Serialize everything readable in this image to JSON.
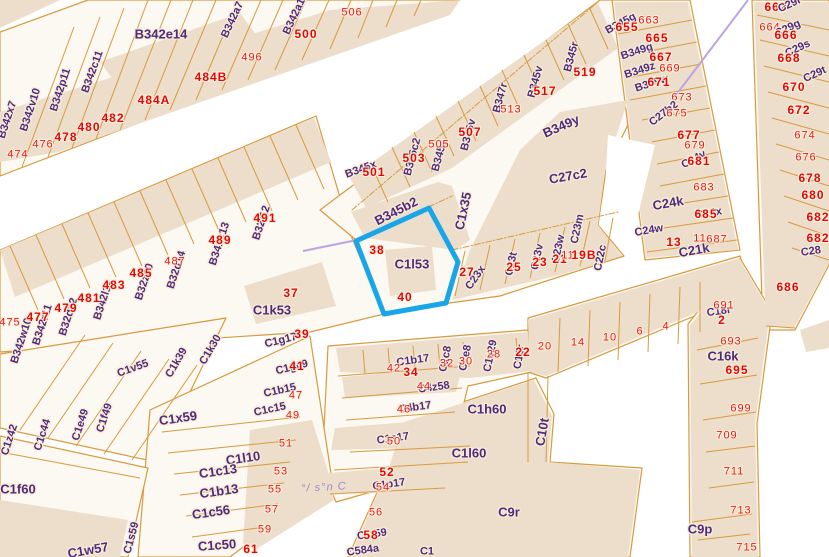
{
  "map": {
    "highlight": {
      "parcel_id": "C1l53",
      "color": "#18a6e8",
      "numbers": [
        "38",
        "40"
      ]
    },
    "colors": {
      "parcel_line": "#d89a3e",
      "building_fill": "#ecdecb",
      "block_fill": "#fcf8f2",
      "parcel_text": "#4f2b80",
      "number_text": "#ef1515",
      "annotation": "#9f87cc",
      "boundary_line": "#bda4e0"
    },
    "annotation_text": "°/ s°n C",
    "labels": [
      {
        "t": "B342x7",
        "x": 8,
        "y": 120,
        "r": -72,
        "k": "p"
      },
      {
        "t": "B342v10",
        "x": 31,
        "y": 110,
        "r": -72,
        "k": "p"
      },
      {
        "t": "B342p11",
        "x": 61,
        "y": 90,
        "r": -72,
        "k": "p"
      },
      {
        "t": "B342c11",
        "x": 93,
        "y": 72,
        "r": -70,
        "k": "p"
      },
      {
        "t": "B342e14",
        "x": 161,
        "y": 34,
        "r": 0,
        "k": "p",
        "lg": true
      },
      {
        "t": "B342a7",
        "x": 233,
        "y": 20,
        "r": -65,
        "k": "p"
      },
      {
        "t": "496",
        "x": 252,
        "y": 58,
        "k": "n"
      },
      {
        "t": "484B",
        "x": 211,
        "y": 77,
        "k": "b"
      },
      {
        "t": "484A",
        "x": 154,
        "y": 100,
        "k": "b"
      },
      {
        "t": "482",
        "x": 113,
        "y": 118,
        "k": "b"
      },
      {
        "t": "480",
        "x": 89,
        "y": 127,
        "k": "b"
      },
      {
        "t": "478",
        "x": 66,
        "y": 137,
        "k": "b"
      },
      {
        "t": "476",
        "x": 43,
        "y": 145,
        "k": "n"
      },
      {
        "t": "474",
        "x": 18,
        "y": 155,
        "k": "n"
      },
      {
        "t": "B342a13",
        "x": 296,
        "y": 14,
        "r": -65,
        "k": "p"
      },
      {
        "t": "500",
        "x": 306,
        "y": 34,
        "k": "b"
      },
      {
        "t": "506",
        "x": 352,
        "y": 13,
        "k": "n"
      },
      {
        "t": "B342w10",
        "x": 22,
        "y": 341,
        "r": -72,
        "k": "p"
      },
      {
        "t": "475",
        "x": 10,
        "y": 323,
        "k": "n"
      },
      {
        "t": "B342r11",
        "x": 43,
        "y": 325,
        "r": -72,
        "k": "p"
      },
      {
        "t": "477",
        "x": 38,
        "y": 317,
        "k": "b"
      },
      {
        "t": "B32d12",
        "x": 69,
        "y": 317,
        "r": -72,
        "k": "p"
      },
      {
        "t": "479",
        "x": 66,
        "y": 308,
        "k": "b"
      },
      {
        "t": "B342l12",
        "x": 104,
        "y": 300,
        "r": -72,
        "k": "p"
      },
      {
        "t": "481",
        "x": 89,
        "y": 298,
        "k": "b"
      },
      {
        "t": "483",
        "x": 114,
        "y": 285,
        "k": "b"
      },
      {
        "t": "B32z10",
        "x": 145,
        "y": 282,
        "r": -72,
        "k": "p"
      },
      {
        "t": "485",
        "x": 141,
        "y": 273,
        "k": "b"
      },
      {
        "t": "B32d14",
        "x": 177,
        "y": 270,
        "r": -72,
        "k": "p"
      },
      {
        "t": "487",
        "x": 175,
        "y": 262,
        "k": "n"
      },
      {
        "t": "B341k13",
        "x": 220,
        "y": 244,
        "r": -72,
        "k": "p"
      },
      {
        "t": "489",
        "x": 220,
        "y": 240,
        "k": "b"
      },
      {
        "t": "B32l12",
        "x": 262,
        "y": 223,
        "r": -72,
        "k": "p"
      },
      {
        "t": "491",
        "x": 265,
        "y": 218,
        "k": "b"
      },
      {
        "t": "C1k53",
        "x": 272,
        "y": 310,
        "k": "p",
        "lg": true
      },
      {
        "t": "37",
        "x": 291,
        "y": 293,
        "k": "b"
      },
      {
        "t": "C1g17",
        "x": 281,
        "y": 341,
        "r": -14,
        "k": "p"
      },
      {
        "t": "39",
        "x": 302,
        "y": 334,
        "k": "b"
      },
      {
        "t": "C1g49",
        "x": 292,
        "y": 368,
        "r": -14,
        "k": "p"
      },
      {
        "t": "41",
        "x": 297,
        "y": 366,
        "k": "b"
      },
      {
        "t": "C1b15",
        "x": 280,
        "y": 391,
        "r": -12,
        "k": "p"
      },
      {
        "t": "47",
        "x": 296,
        "y": 396,
        "k": "n"
      },
      {
        "t": "C1c15",
        "x": 270,
        "y": 410,
        "r": -12,
        "k": "p"
      },
      {
        "t": "49",
        "x": 293,
        "y": 416,
        "k": "n"
      },
      {
        "t": "B345x",
        "x": 361,
        "y": 170,
        "r": -20,
        "k": "p"
      },
      {
        "t": "501",
        "x": 374,
        "y": 172,
        "k": "b"
      },
      {
        "t": "B345c2",
        "x": 413,
        "y": 157,
        "r": -75,
        "k": "p"
      },
      {
        "t": "503",
        "x": 414,
        "y": 158,
        "k": "b"
      },
      {
        "t": "B345z",
        "x": 440,
        "y": 156,
        "r": -75,
        "k": "p"
      },
      {
        "t": "505",
        "x": 439,
        "y": 145,
        "k": "n"
      },
      {
        "t": "B345v",
        "x": 469,
        "y": 135,
        "r": -75,
        "k": "p"
      },
      {
        "t": "507",
        "x": 470,
        "y": 132,
        "k": "b"
      },
      {
        "t": "B347r",
        "x": 501,
        "y": 98,
        "r": -75,
        "k": "p"
      },
      {
        "t": "513",
        "x": 511,
        "y": 110,
        "k": "n"
      },
      {
        "t": "B345v",
        "x": 536,
        "y": 82,
        "r": -75,
        "k": "p"
      },
      {
        "t": "517",
        "x": 545,
        "y": 91,
        "k": "b"
      },
      {
        "t": "B345r",
        "x": 572,
        "y": 57,
        "r": -75,
        "k": "p"
      },
      {
        "t": "519",
        "x": 585,
        "y": 72,
        "k": "b"
      },
      {
        "t": "B349y",
        "x": 561,
        "y": 126,
        "r": -24,
        "k": "p",
        "lg": true
      },
      {
        "t": "C27c2",
        "x": 568,
        "y": 176,
        "r": -10,
        "k": "p",
        "lg": true
      },
      {
        "t": "B345b2",
        "x": 396,
        "y": 211,
        "r": -27,
        "k": "p",
        "lg": true
      },
      {
        "t": "C1x35",
        "x": 463,
        "y": 211,
        "r": -78,
        "k": "p",
        "lg": true
      },
      {
        "t": "C1l53",
        "x": 412,
        "y": 264,
        "k": "p",
        "lg": true
      },
      {
        "t": "38",
        "x": 377,
        "y": 250,
        "k": "b"
      },
      {
        "t": "40",
        "x": 405,
        "y": 297,
        "k": "b"
      },
      {
        "t": "C23x",
        "x": 476,
        "y": 278,
        "r": -55,
        "k": "p"
      },
      {
        "t": "27",
        "x": 467,
        "y": 272,
        "k": "b"
      },
      {
        "t": "C23t",
        "x": 512,
        "y": 264,
        "r": -78,
        "k": "p"
      },
      {
        "t": "25",
        "x": 514,
        "y": 267,
        "k": "b"
      },
      {
        "t": "C23v",
        "x": 538,
        "y": 257,
        "r": -78,
        "k": "p"
      },
      {
        "t": "23",
        "x": 540,
        "y": 262,
        "k": "b"
      },
      {
        "t": "C23w",
        "x": 559,
        "y": 249,
        "r": -78,
        "k": "p"
      },
      {
        "t": "21",
        "x": 560,
        "y": 259,
        "k": "b"
      },
      {
        "t": "11",
        "x": 568,
        "y": 256,
        "k": "n"
      },
      {
        "t": "C23m",
        "x": 578,
        "y": 229,
        "r": -78,
        "k": "p"
      },
      {
        "t": "19B",
        "x": 584,
        "y": 255,
        "k": "b"
      },
      {
        "t": "C22c",
        "x": 601,
        "y": 258,
        "r": -78,
        "k": "p"
      },
      {
        "t": "B345g",
        "x": 621,
        "y": 24,
        "r": -28,
        "k": "p"
      },
      {
        "t": "655",
        "x": 627,
        "y": 27,
        "k": "b"
      },
      {
        "t": "663",
        "x": 649,
        "y": 21,
        "k": "n"
      },
      {
        "t": "B349g",
        "x": 637,
        "y": 52,
        "r": -18,
        "k": "p"
      },
      {
        "t": "665",
        "x": 657,
        "y": 38,
        "k": "b"
      },
      {
        "t": "B349z",
        "x": 640,
        "y": 71,
        "r": -18,
        "k": "p"
      },
      {
        "t": "667",
        "x": 661,
        "y": 57,
        "k": "b"
      },
      {
        "t": "669",
        "x": 670,
        "y": 69,
        "k": "n"
      },
      {
        "t": "B349w",
        "x": 652,
        "y": 84,
        "r": -18,
        "k": "p"
      },
      {
        "t": "671",
        "x": 659,
        "y": 82,
        "k": "b"
      },
      {
        "t": "673",
        "x": 682,
        "y": 98,
        "k": "n"
      },
      {
        "t": "C27b2",
        "x": 664,
        "y": 114,
        "r": -38,
        "k": "p"
      },
      {
        "t": "675",
        "x": 677,
        "y": 114,
        "k": "n"
      },
      {
        "t": "677",
        "x": 689,
        "y": 135,
        "k": "b"
      },
      {
        "t": "679",
        "x": 695,
        "y": 146,
        "k": "n"
      },
      {
        "t": "C24v",
        "x": 694,
        "y": 160,
        "r": -28,
        "k": "p"
      },
      {
        "t": "681",
        "x": 699,
        "y": 161,
        "k": "b"
      },
      {
        "t": "683",
        "x": 704,
        "y": 188,
        "k": "n"
      },
      {
        "t": "C24k",
        "x": 668,
        "y": 203,
        "r": -10,
        "k": "p",
        "lg": true
      },
      {
        "t": "C24x",
        "x": 709,
        "y": 214,
        "r": -10,
        "k": "p"
      },
      {
        "t": "685",
        "x": 706,
        "y": 214,
        "k": "b"
      },
      {
        "t": "C24w",
        "x": 649,
        "y": 231,
        "r": -10,
        "k": "p"
      },
      {
        "t": "13",
        "x": 674,
        "y": 242,
        "k": "b"
      },
      {
        "t": "11",
        "x": 700,
        "y": 239,
        "k": "n"
      },
      {
        "t": "687",
        "x": 717,
        "y": 240,
        "k": "n"
      },
      {
        "t": "C21k",
        "x": 694,
        "y": 250,
        "r": -10,
        "k": "p",
        "lg": true
      },
      {
        "t": "662",
        "x": 776,
        "y": 7,
        "k": "b"
      },
      {
        "t": "C29r",
        "x": 790,
        "y": 5,
        "r": -25,
        "k": "p"
      },
      {
        "t": "664",
        "x": 770,
        "y": 28,
        "k": "n"
      },
      {
        "t": "C29g",
        "x": 788,
        "y": 29,
        "r": -25,
        "k": "p"
      },
      {
        "t": "666",
        "x": 786,
        "y": 35,
        "k": "b"
      },
      {
        "t": "C29s",
        "x": 798,
        "y": 49,
        "r": -25,
        "k": "p"
      },
      {
        "t": "668",
        "x": 789,
        "y": 58,
        "k": "b"
      },
      {
        "t": "C29t",
        "x": 815,
        "y": 75,
        "r": -25,
        "k": "p"
      },
      {
        "t": "670",
        "x": 794,
        "y": 87,
        "k": "b"
      },
      {
        "t": "672",
        "x": 799,
        "y": 110,
        "k": "b"
      },
      {
        "t": "674",
        "x": 805,
        "y": 136,
        "k": "n"
      },
      {
        "t": "676",
        "x": 806,
        "y": 158,
        "k": "n"
      },
      {
        "t": "678",
        "x": 810,
        "y": 178,
        "k": "b"
      },
      {
        "t": "680",
        "x": 813,
        "y": 195,
        "k": "b"
      },
      {
        "t": "682",
        "x": 818,
        "y": 217,
        "k": "b"
      },
      {
        "t": "682",
        "x": 818,
        "y": 238,
        "k": "b"
      },
      {
        "t": "C28",
        "x": 811,
        "y": 252,
        "r": -8,
        "k": "p"
      },
      {
        "t": "686",
        "x": 788,
        "y": 287,
        "k": "b"
      },
      {
        "t": "20",
        "x": 545,
        "y": 347,
        "k": "n"
      },
      {
        "t": "14",
        "x": 578,
        "y": 343,
        "k": "n"
      },
      {
        "t": "10",
        "x": 610,
        "y": 338,
        "k": "n"
      },
      {
        "t": "6",
        "x": 640,
        "y": 332,
        "k": "n"
      },
      {
        "t": "4",
        "x": 666,
        "y": 327,
        "k": "n"
      },
      {
        "t": "C18r",
        "x": 719,
        "y": 312,
        "r": -8,
        "k": "p"
      },
      {
        "t": "691",
        "x": 724,
        "y": 306,
        "k": "n"
      },
      {
        "t": "2",
        "x": 722,
        "y": 320,
        "k": "b"
      },
      {
        "t": "C10r",
        "x": 520,
        "y": 357,
        "r": -80,
        "k": "p"
      },
      {
        "t": "22",
        "x": 523,
        "y": 352,
        "k": "b"
      },
      {
        "t": "C10t",
        "x": 542,
        "y": 432,
        "r": -80,
        "k": "p",
        "lg": true
      },
      {
        "t": "C1b17",
        "x": 413,
        "y": 361,
        "r": -8,
        "k": "p"
      },
      {
        "t": "42",
        "x": 394,
        "y": 369,
        "k": "n"
      },
      {
        "t": "34",
        "x": 411,
        "y": 372,
        "k": "b"
      },
      {
        "t": "C1c8",
        "x": 446,
        "y": 359,
        "r": -78,
        "k": "p"
      },
      {
        "t": "32",
        "x": 447,
        "y": 364,
        "k": "n"
      },
      {
        "t": "C1e8",
        "x": 466,
        "y": 358,
        "r": -78,
        "k": "p"
      },
      {
        "t": "30",
        "x": 466,
        "y": 362,
        "k": "n"
      },
      {
        "t": "C1v29",
        "x": 491,
        "y": 356,
        "r": -78,
        "k": "p"
      },
      {
        "t": "28",
        "x": 494,
        "y": 355,
        "k": "n"
      },
      {
        "t": "C4z58",
        "x": 434,
        "y": 388,
        "r": -8,
        "k": "p"
      },
      {
        "t": "44",
        "x": 424,
        "y": 387,
        "k": "n"
      },
      {
        "t": "C4b17",
        "x": 415,
        "y": 408,
        "r": -8,
        "k": "p"
      },
      {
        "t": "46",
        "x": 404,
        "y": 410,
        "k": "n"
      },
      {
        "t": "C1h60",
        "x": 487,
        "y": 409,
        "k": "p",
        "lg": true
      },
      {
        "t": "C1s17",
        "x": 393,
        "y": 439,
        "r": -8,
        "k": "p"
      },
      {
        "t": "50",
        "x": 394,
        "y": 442,
        "k": "n"
      },
      {
        "t": "C1l60",
        "x": 469,
        "y": 453,
        "k": "p",
        "lg": true
      },
      {
        "t": "52",
        "x": 387,
        "y": 472,
        "k": "b"
      },
      {
        "t": "C1p17",
        "x": 389,
        "y": 485,
        "r": -8,
        "k": "p"
      },
      {
        "t": "54",
        "x": 383,
        "y": 488,
        "k": "n"
      },
      {
        "t": "56",
        "x": 376,
        "y": 513,
        "k": "n"
      },
      {
        "t": "C1t59",
        "x": 372,
        "y": 535,
        "r": -8,
        "k": "p"
      },
      {
        "t": "58",
        "x": 371,
        "y": 535,
        "k": "b"
      },
      {
        "t": "C584a",
        "x": 363,
        "y": 551,
        "r": -8,
        "k": "p"
      },
      {
        "t": "C1",
        "x": 427,
        "y": 552,
        "k": "p"
      },
      {
        "t": "C9r",
        "x": 509,
        "y": 512,
        "k": "p",
        "lg": true
      },
      {
        "t": "C9p",
        "x": 700,
        "y": 529,
        "k": "p",
        "lg": true
      },
      {
        "t": "693",
        "x": 731,
        "y": 342,
        "k": "n"
      },
      {
        "t": "C16k",
        "x": 723,
        "y": 356,
        "k": "p",
        "lg": true
      },
      {
        "t": "695",
        "x": 737,
        "y": 370,
        "k": "b"
      },
      {
        "t": "699",
        "x": 741,
        "y": 409,
        "k": "n"
      },
      {
        "t": "709",
        "x": 727,
        "y": 436,
        "k": "n"
      },
      {
        "t": "711",
        "x": 734,
        "y": 472,
        "k": "n"
      },
      {
        "t": "713",
        "x": 741,
        "y": 511,
        "k": "n"
      },
      {
        "t": "715",
        "x": 747,
        "y": 548,
        "k": "n"
      },
      {
        "t": "C1v55",
        "x": 133,
        "y": 369,
        "r": -20,
        "k": "p"
      },
      {
        "t": "C1k39",
        "x": 177,
        "y": 363,
        "r": -60,
        "k": "p"
      },
      {
        "t": "C1k30",
        "x": 211,
        "y": 350,
        "r": -60,
        "k": "p"
      },
      {
        "t": "C1f49",
        "x": 105,
        "y": 418,
        "r": -72,
        "k": "p"
      },
      {
        "t": "C1e49",
        "x": 81,
        "y": 425,
        "r": -72,
        "k": "p"
      },
      {
        "t": "C1c44",
        "x": 43,
        "y": 435,
        "r": -72,
        "k": "p"
      },
      {
        "t": "C1z42",
        "x": 10,
        "y": 440,
        "r": -72,
        "k": "p"
      },
      {
        "t": "C1f60",
        "x": 18,
        "y": 489,
        "k": "p",
        "lg": true
      },
      {
        "t": "C1x59",
        "x": 178,
        "y": 418,
        "r": -8,
        "k": "p",
        "lg": true
      },
      {
        "t": "51",
        "x": 286,
        "y": 444,
        "k": "n"
      },
      {
        "t": "C1l10",
        "x": 243,
        "y": 458,
        "r": -8,
        "k": "p",
        "lg": true
      },
      {
        "t": "53",
        "x": 281,
        "y": 472,
        "k": "n"
      },
      {
        "t": "C1c13",
        "x": 218,
        "y": 471,
        "r": -8,
        "k": "p",
        "lg": true
      },
      {
        "t": "55",
        "x": 275,
        "y": 490,
        "k": "n"
      },
      {
        "t": "C1b13",
        "x": 219,
        "y": 491,
        "r": -8,
        "k": "p",
        "lg": true
      },
      {
        "t": "57",
        "x": 272,
        "y": 510,
        "k": "n"
      },
      {
        "t": "C1c56",
        "x": 211,
        "y": 512,
        "r": -8,
        "k": "p",
        "lg": true
      },
      {
        "t": "59",
        "x": 265,
        "y": 530,
        "k": "n"
      },
      {
        "t": "C1c50",
        "x": 217,
        "y": 545,
        "r": -4,
        "k": "p",
        "lg": true
      },
      {
        "t": "61",
        "x": 251,
        "y": 549,
        "k": "b"
      },
      {
        "t": "C1s59",
        "x": 132,
        "y": 538,
        "r": -75,
        "k": "p"
      },
      {
        "t": "C1w57",
        "x": 88,
        "y": 550,
        "r": -10,
        "k": "p",
        "lg": true
      },
      {
        "t": "°/ s°n C",
        "x": 324,
        "y": 488,
        "r": -3,
        "k": "s"
      }
    ]
  }
}
